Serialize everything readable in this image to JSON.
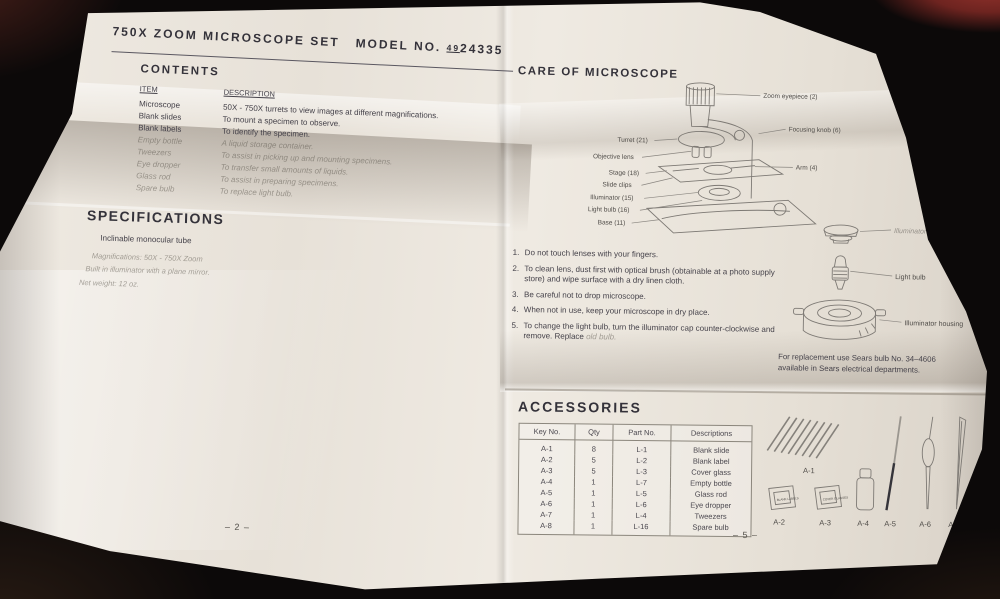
{
  "header": {
    "title_main": "750X ZOOM MICROSCOPE SET",
    "model_label": "MODEL NO.",
    "model_prefix": "49",
    "model_number": "24335"
  },
  "left_page": {
    "contents": {
      "heading": "CONTENTS",
      "col_item": "ITEM",
      "col_description": "DESCRIPTION",
      "rows": [
        {
          "item": "Microscope",
          "description": "50X - 750X turrets to view images at different magnifications."
        },
        {
          "item": "Blank slides",
          "description": "To mount a specimen to observe."
        },
        {
          "item": "Blank labels",
          "description": "To identify the specimen."
        },
        {
          "item": "Empty bottle",
          "description": "A liquid storage container."
        },
        {
          "item": "Tweezers",
          "description": "To assist in picking up and mounting specimens."
        },
        {
          "item": "Eye dropper",
          "description": "To transfer small amounts of liquids."
        },
        {
          "item": "Glass rod",
          "description": "To assist in preparing specimens."
        },
        {
          "item": "Spare bulb",
          "description": "To replace light bulb."
        }
      ]
    },
    "specifications": {
      "heading": "SPECIFICATIONS",
      "lines": [
        "Inclinable monocular tube",
        "Magnifications:  50X - 750X  Zoom",
        "Built in illuminator with a plane mirror.",
        "Net weight:  12 oz."
      ]
    },
    "page_number": "– 2 –"
  },
  "right_page": {
    "care": {
      "heading": "CARE OF MICROSCOPE",
      "diagram_labels": {
        "zoom_eyepiece": "Zoom eyepiece (2)",
        "focusing_knob": "Focusing knob (6)",
        "arm": "Arm (4)",
        "turret": "Turret (21)",
        "objective_lens": "Objective lens",
        "stage": "Stage (18)",
        "slide_clips": "Slide clips",
        "illuminator": "Illuminator (15)",
        "light_bulb": "Light bulb (16)",
        "base": "Base (11)"
      },
      "steps": [
        {
          "num": "1.",
          "text": "Do not touch lenses with your fingers."
        },
        {
          "num": "2.",
          "text": "To clean lens, dust first with optical brush (obtainable at a photo supply store) and wipe surface with a dry linen cloth."
        },
        {
          "num": "3.",
          "text": "Be careful not to drop microscope."
        },
        {
          "num": "4.",
          "text": "When not in use, keep your microscope in dry place."
        },
        {
          "num": "5.",
          "text": "To change the light bulb, turn the illuminator cap counter-clockwise and remove.  Replace"
        }
      ],
      "step5_faint": "old bulb."
    },
    "bulb_diagram": {
      "labels": {
        "cap": "Illuminator cap",
        "bulb": "Light bulb",
        "housing": "Illuminator housing"
      },
      "note_line1": "For replacement use Sears bulb No. 34–4606",
      "note_line2": "available in Sears electrical departments."
    },
    "accessories": {
      "heading": "ACCESSORIES",
      "headers": [
        "Key No.",
        "Qty",
        "Part No.",
        "Descriptions"
      ],
      "rows": [
        {
          "key": "A-1",
          "qty": "8",
          "part": "L-1",
          "description": "Blank slide"
        },
        {
          "key": "A-2",
          "qty": "5",
          "part": "L-2",
          "description": "Blank label"
        },
        {
          "key": "A-3",
          "qty": "5",
          "part": "L-3",
          "description": "Cover glass"
        },
        {
          "key": "A-4",
          "qty": "1",
          "part": "L-7",
          "description": "Empty bottle"
        },
        {
          "key": "A-5",
          "qty": "1",
          "part": "L-5",
          "description": "Glass rod"
        },
        {
          "key": "A-6",
          "qty": "1",
          "part": "L-6",
          "description": "Eye dropper"
        },
        {
          "key": "A-7",
          "qty": "1",
          "part": "L-4",
          "description": "Tweezers"
        },
        {
          "key": "A-8",
          "qty": "1",
          "part": "L-16",
          "description": "Spare bulb"
        }
      ],
      "item_labels": [
        "A-1",
        "A-2",
        "A-3",
        "A-4",
        "A-5",
        "A-6",
        "A-7",
        "A-8"
      ],
      "box_labels": [
        "BLANK LABELS",
        "COVER GLASSES"
      ]
    },
    "page_number": "– 5 –"
  },
  "colors": {
    "paper": "#ece7df",
    "ink": "#45424a",
    "background": "#0c0909"
  }
}
